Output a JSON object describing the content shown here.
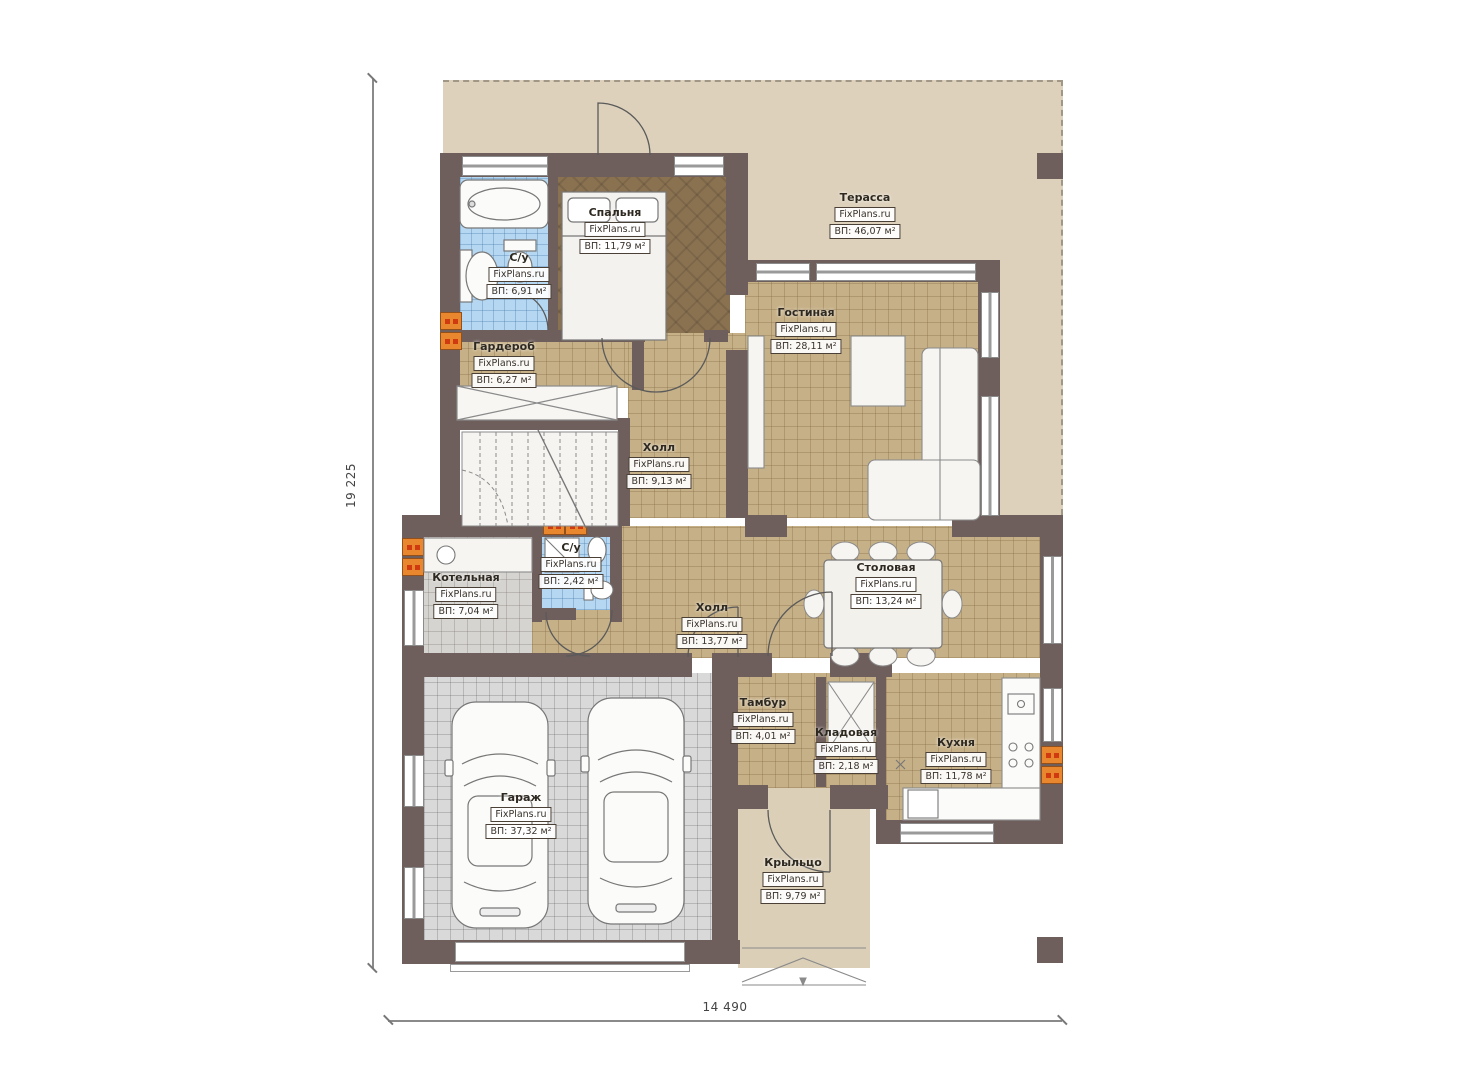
{
  "watermark": "FixPlans.ru",
  "dimensions": {
    "left": "19 225",
    "bottom": "14 490"
  },
  "rooms": [
    {
      "name": "Терасса",
      "area": "ВП: 46,07 м²"
    },
    {
      "name": "Спальня",
      "area": "ВП: 11,79 м²"
    },
    {
      "name": "С/у",
      "area": "ВП: 6,91 м²"
    },
    {
      "name": "Гардероб",
      "area": "ВП: 6,27 м²"
    },
    {
      "name": "Холл",
      "area": "ВП: 9,13 м²"
    },
    {
      "name": "Гостиная",
      "area": "ВП: 28,11 м²"
    },
    {
      "name": "Котельная",
      "area": "ВП: 7,04 м²"
    },
    {
      "name": "С/у",
      "area": "ВП: 2,42 м²"
    },
    {
      "name": "Холл",
      "area": "ВП: 13,77 м²"
    },
    {
      "name": "Столовая",
      "area": "ВП: 13,24 м²"
    },
    {
      "name": "Тамбур",
      "area": "ВП: 4,01 м²"
    },
    {
      "name": "Кладовая",
      "area": "ВП: 2,18 м²"
    },
    {
      "name": "Кухня",
      "area": "ВП: 11,78 м²"
    },
    {
      "name": "Гараж",
      "area": "ВП: 37,32 м²"
    },
    {
      "name": "Крыльцо",
      "area": "ВП: 9,79 м²"
    }
  ],
  "colors": {
    "wall": "#6e5e5c",
    "terrace": "#ddd1bc",
    "floor_tan": "#c6b087",
    "floor_bedroom": "#8a7251",
    "floor_bath": "#b5d7f1",
    "floor_garage": "#d9d9d9",
    "porch": "#dbcfb8",
    "vent": "#e8872e"
  }
}
